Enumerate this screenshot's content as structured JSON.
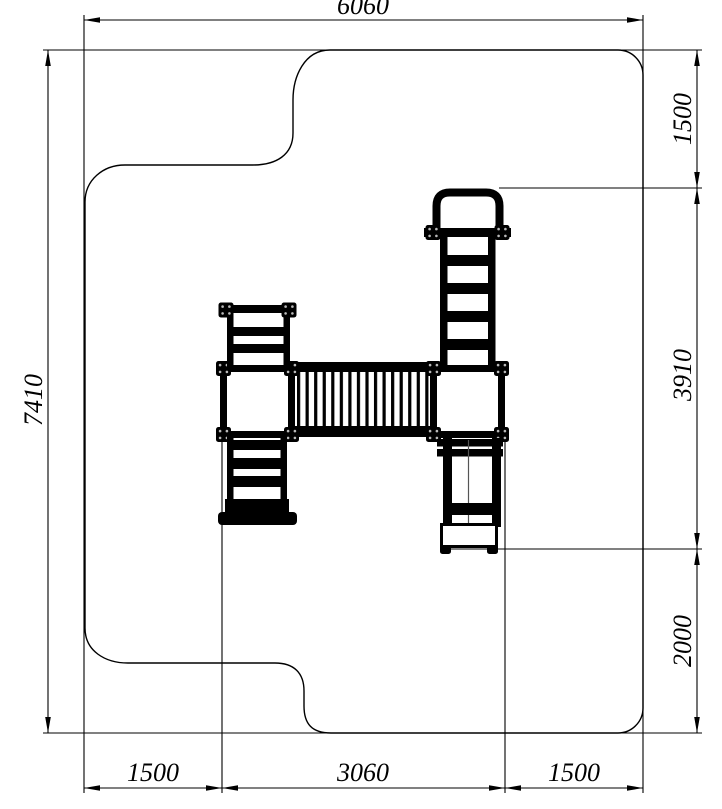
{
  "drawing": {
    "type": "technical-plan-drawing",
    "dimensions": {
      "top": "6060",
      "left": "7410",
      "right_top": "1500",
      "right_middle": "3910",
      "right_bottom": "2000",
      "bottom_left": "1500",
      "bottom_middle": "3060",
      "bottom_right": "1500"
    },
    "colors": {
      "line": "#000000",
      "background": "#ffffff"
    }
  }
}
